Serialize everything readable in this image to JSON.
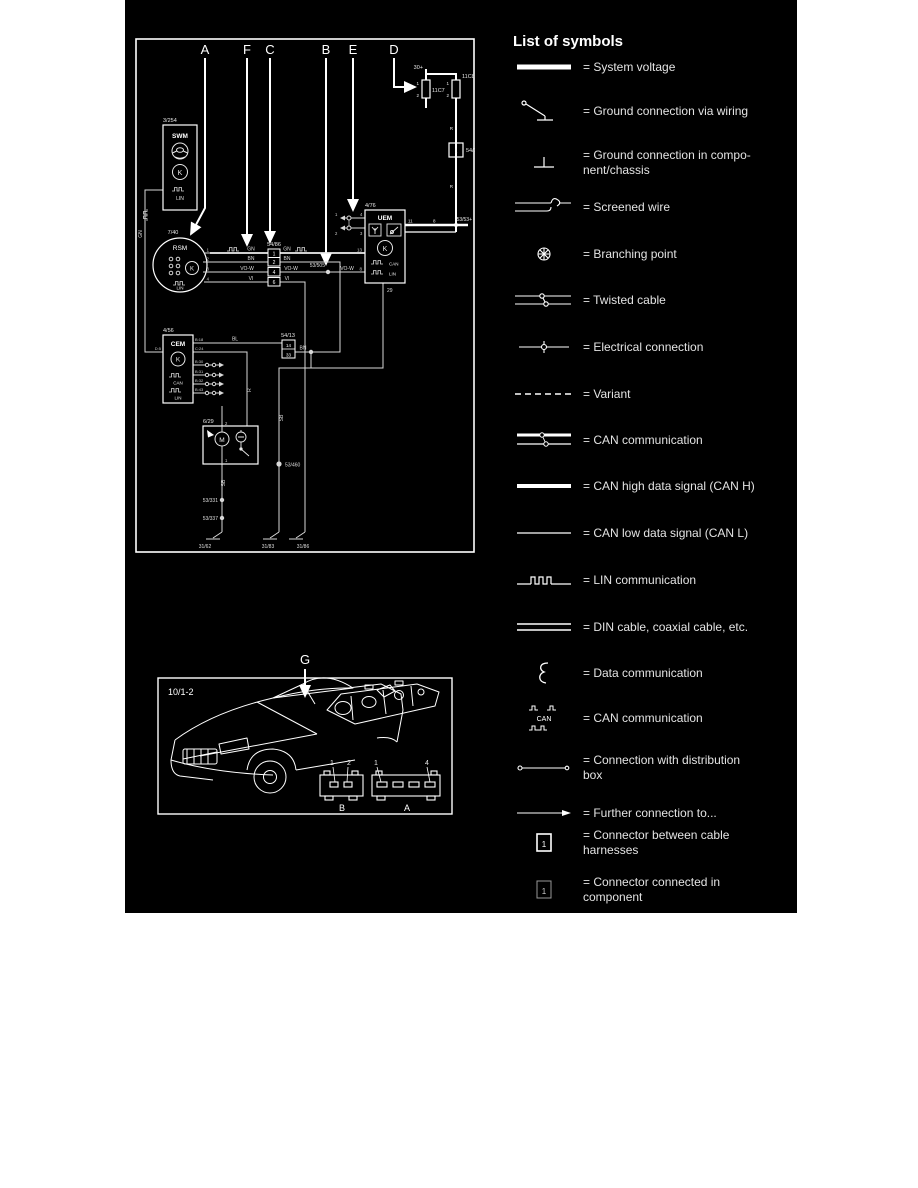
{
  "legend": {
    "title": "List of symbols",
    "connector_digit": "1",
    "can_symbol_text": "CAN",
    "items": [
      {
        "label": "= System voltage"
      },
      {
        "label": "= Ground connection via wiring"
      },
      {
        "label": "= Ground connection in compo-",
        "label2": "nent/chassis"
      },
      {
        "label": "= Screened wire"
      },
      {
        "label": "= Branching point"
      },
      {
        "label": "= Twisted cable"
      },
      {
        "label": "= Electrical connection"
      },
      {
        "label": "= Variant"
      },
      {
        "label": "= CAN communication"
      },
      {
        "label": "= CAN high data signal (CAN H)"
      },
      {
        "label": "= CAN low data signal (CAN L)"
      },
      {
        "label": "= LIN communication"
      },
      {
        "label": "= DIN cable, coaxial cable, etc."
      },
      {
        "label": "= Data communication"
      },
      {
        "label": "= CAN communication"
      },
      {
        "label": "= Connection with distribution",
        "label2": "box"
      },
      {
        "label": "= Further connection to..."
      },
      {
        "label": "= Connector between cable",
        "label2": "harnesses"
      },
      {
        "label": "= Connector connected in",
        "label2": "component"
      }
    ]
  },
  "diagram": {
    "callouts": {
      "a": "A",
      "f": "F",
      "c": "C",
      "b": "B",
      "e": "E",
      "d": "D"
    },
    "power": {
      "terminal": "30+",
      "fuse1": "11C7",
      "fuse2": "11C8",
      "f1p1": "1",
      "f1p2": "2",
      "f2p1": "1",
      "f2p2": "2",
      "conn": "54/13",
      "conn_pin": "1",
      "junction": "53/53+"
    },
    "swm": {
      "ref": "3/254",
      "name": "SWM",
      "lin": "LIN",
      "key": "K"
    },
    "rsm": {
      "ref": "7/40",
      "name": "RSM",
      "lin": "LIN",
      "key": "K",
      "p1": "1",
      "p2": "2",
      "p3": "3",
      "p4": "4"
    },
    "uem": {
      "ref": "4/76",
      "name": "UEM",
      "key": "K",
      "can": "CAN",
      "lin": "LIN",
      "pin13": "13",
      "pin8l": "8",
      "pin11": "11",
      "pin8r": "8",
      "pin29": "29"
    },
    "cem": {
      "ref": "4/56",
      "name": "CEM",
      "key": "K",
      "can": "CAN",
      "lin": "LIN",
      "pin_left": "D:5",
      "pr1": "B:18",
      "pr2": "C:24",
      "pr3": "B:30",
      "pr4": "B:31",
      "pr5": "B:32",
      "pr6": "B:43"
    },
    "motor": {
      "ref": "6/29",
      "m": "M",
      "p1": "1",
      "p2": "2"
    },
    "conn5486": {
      "ref": "54/86",
      "c1": "1",
      "c2": "2",
      "c3": "4",
      "c4": "6"
    },
    "conn5413b": {
      "ref": "54/13",
      "c1": "14",
      "c2": "33"
    },
    "twisted": {
      "p1": "1",
      "p2": "2",
      "p3": "4",
      "p4": "3"
    },
    "splices": {
      "s505": "53/505",
      "s460": "53/460",
      "s331": "53/331",
      "s337": "53/337"
    },
    "grounds": {
      "g1": "31/62",
      "g2": "31/83",
      "g3": "31/86"
    },
    "wires": {
      "gn1": "GN",
      "gn2": "GN",
      "gnv": "GN",
      "bn1": "BN",
      "bn2": "BN",
      "bn3": "BN",
      "vow1": "VO-W",
      "vow2": "VO-W",
      "vow3": "VO-W",
      "vi1": "VI",
      "vi2": "VI",
      "bl": "BL",
      "sb1": "SB",
      "sb2": "SB",
      "r1": "R",
      "r2": "R"
    }
  },
  "location": {
    "callout": "G",
    "ref": "10/1-2",
    "conn_b": "B",
    "conn_a": "A",
    "b1": "1",
    "b2": "2",
    "a1": "1",
    "a4": "4"
  }
}
